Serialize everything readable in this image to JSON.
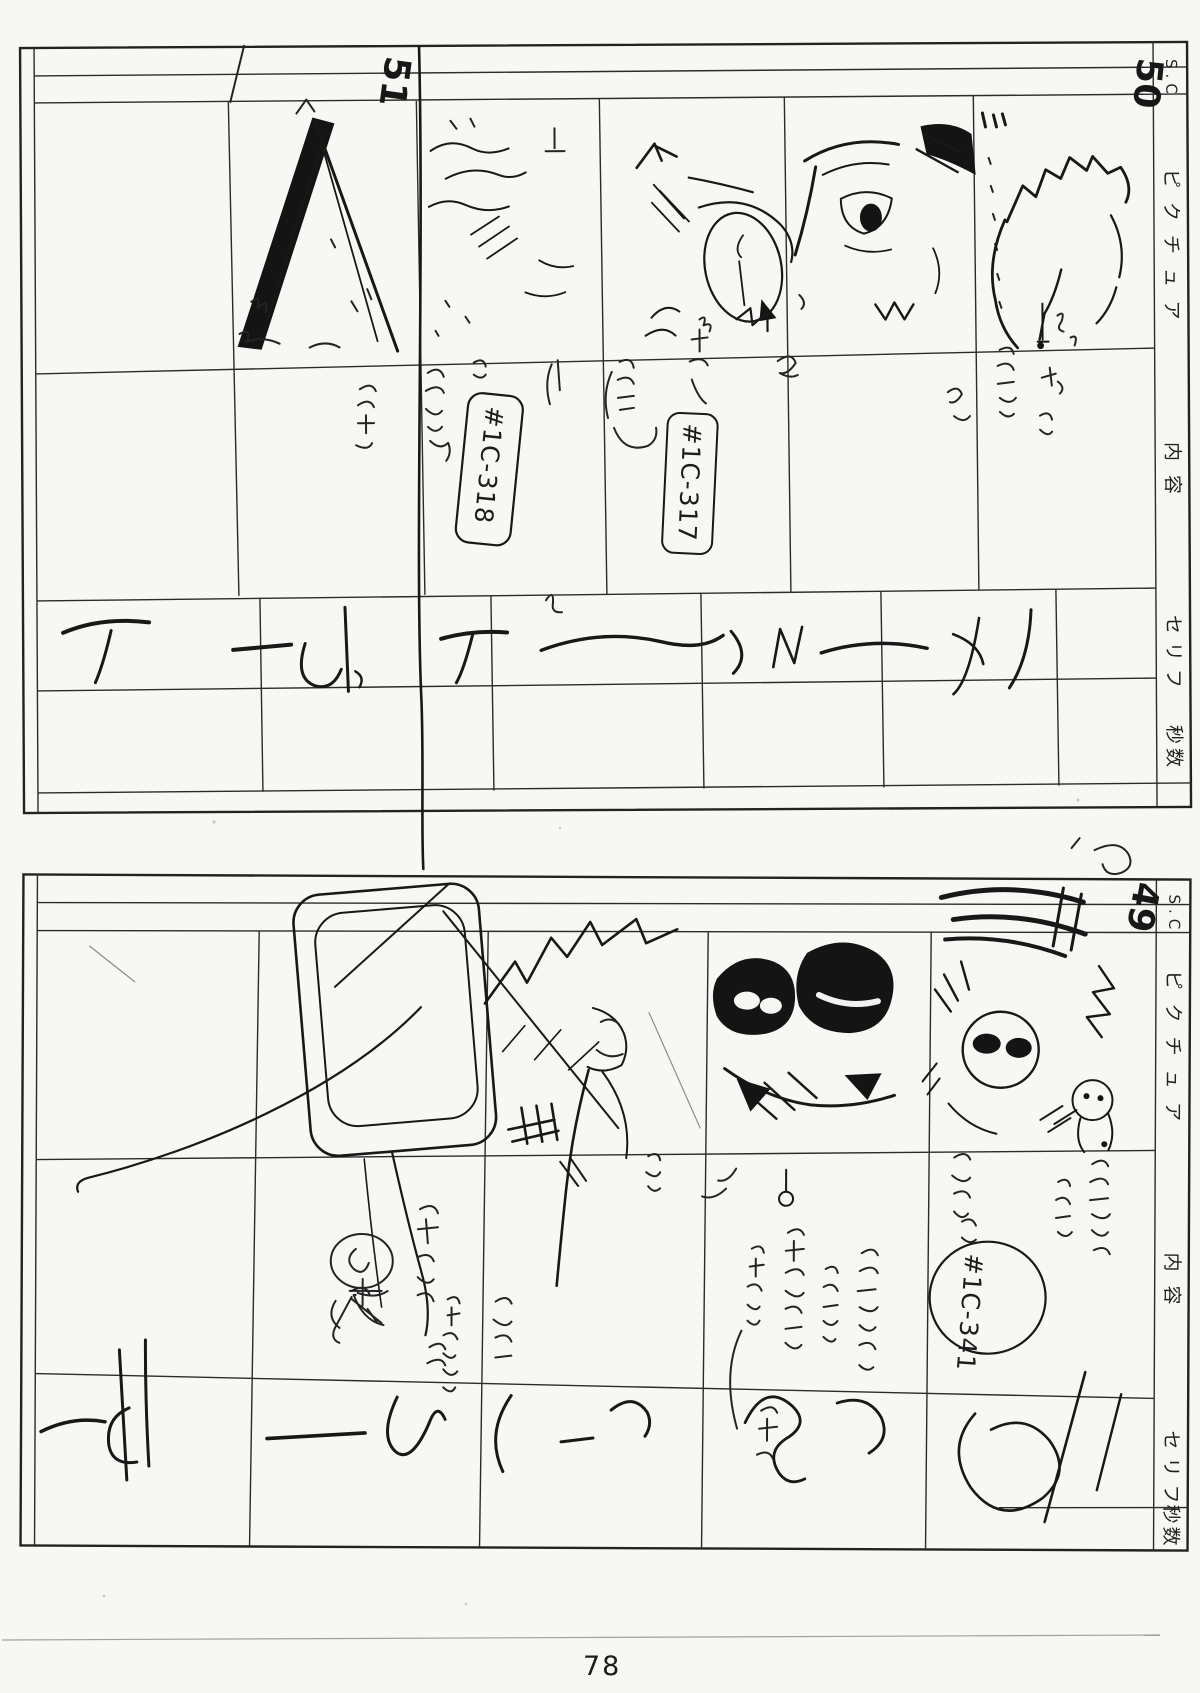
{
  "page": {
    "number": "78",
    "paper_color": "#f7f7f4",
    "ink_color": "#1d1d1d",
    "description": "Scanned hand-drawn anime storyboard page, two sheets rotated 90 degrees"
  },
  "boards": [
    {
      "name": "storyboard-sheet-top",
      "column_headers": {
        "sc": "S.C",
        "picture": "ピクチュア",
        "content": "内容",
        "dialog": "セリフ",
        "seconds": "秒数"
      },
      "scene_numbers": {
        "right": "50",
        "left": "51"
      },
      "cut_labels": {
        "box_1": "#1C-318",
        "box_2": "#1C-317"
      }
    },
    {
      "name": "storyboard-sheet-bottom",
      "column_headers": {
        "sc": "S.C",
        "picture": "ピクチュア",
        "content": "内容",
        "dialog": "セリフ",
        "seconds": "秒数"
      },
      "scene_numbers": {
        "right": "49"
      },
      "cut_labels": {
        "circle_1": "#1C-341"
      }
    }
  ]
}
